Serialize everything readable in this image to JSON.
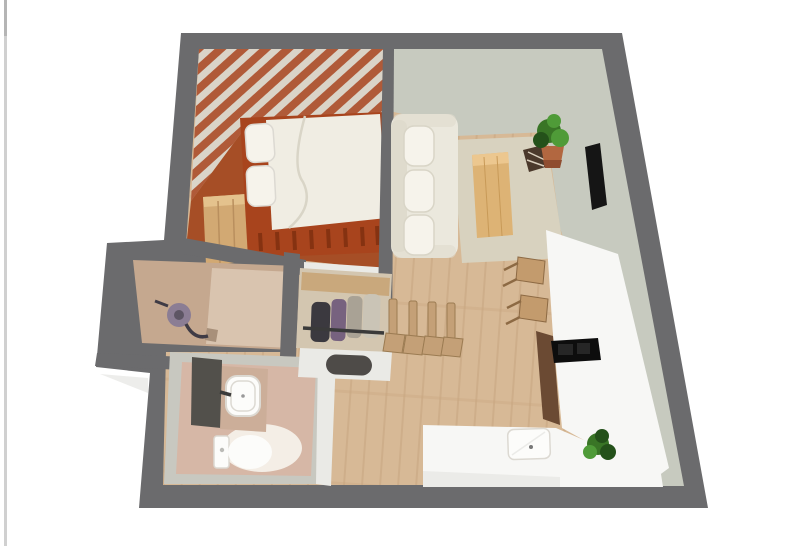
{
  "page": {
    "background": "#ffffff"
  },
  "floorplan": {
    "description": "3D top-down render of a studio apartment floor plan",
    "colors": {
      "wall": "#6b6b6d",
      "floor-wood": "#d7b996",
      "floor-wood-line": "#c7a67f",
      "sage-wall": "#c7cabf",
      "stripe-terracotta": "#b05a38",
      "stripe-cream": "#dad4c8",
      "bedroom-floor": "#a64e26",
      "bed-frame": "#a8441d",
      "bed-slat": "#7f3010",
      "duvet": "#f0ede3",
      "duvet-fold": "#d9d5c7",
      "pillow": "#f6f3eb",
      "wardrobe-wood": "#d2a973",
      "wardrobe-top": "#e4c28d",
      "wardrobe-seam": "#b98f5e",
      "sofa": "#ebe8dd",
      "sofa-shade": "#dfdbcd",
      "rug": "#d8d2bf",
      "table-wood": "#ddb375",
      "table-wood-light": "#ecc78f",
      "table-grain": "#c89a58",
      "plant-green": "#397526",
      "plant-green-light": "#4f9b38",
      "plant-dark": "#24511a",
      "pot": "#b26740",
      "pot-dark": "#8f4d30",
      "tv": "#151515",
      "decor-dark": "#4b392b",
      "decor-light": "#d9cebc",
      "counter": "#f7f7f5",
      "counter-shade": "#ebebe8",
      "cooktop": "#0d0d0d",
      "cooktop-inner": "#262626",
      "cabinet-brown": "#6b4a33",
      "stool-wood": "#c39b6d",
      "stool-leg": "#8d6a44",
      "chair-wood": "#c4a077",
      "chair-edge": "#9b7b52",
      "balcony-floor": "#c5a88f",
      "balcony-floor-light": "#d9c4af",
      "balcony-drain": "#a8907a",
      "bathroom-ring": "#c8c8c0",
      "bathroom-floor": "#d6b7a6",
      "vanity-top": "#ccae99",
      "fixture-white": "#fcfcfa",
      "fixture-edge": "#dcd9d2",
      "glow-white": "#f6f0e9",
      "panel-dark": "#52504b",
      "mat-dark": "#4e4b48",
      "partition-white": "#eaeae6",
      "closet-floor": "#d3c6b0",
      "closet-shelf": "#c9a87c",
      "rail-dark": "#3a3a3a",
      "clothes-dark": "#3b393f",
      "clothes-purple": "#77627f",
      "clothes-gray": "#a9a295",
      "clothes-light": "#cac4b6",
      "vacuum-purple": "#8b7d94",
      "vacuum-dark": "#3f3b45",
      "page-edge": "#d0d0d0",
      "page-edge-dark": "#b5b5b5",
      "shadow": "#ededeb"
    },
    "rooms": [
      {
        "name": "bedroom",
        "features": [
          "striped wallpaper",
          "double bed",
          "wardrobe"
        ]
      },
      {
        "name": "living-area",
        "features": [
          "sofa",
          "rug",
          "coffee table",
          "potted plant",
          "wall tv",
          "magazine rack"
        ]
      },
      {
        "name": "kitchen",
        "features": [
          "l-shaped counter",
          "cooktop",
          "sink",
          "bar stools",
          "counter plant"
        ]
      },
      {
        "name": "hallway",
        "features": [
          "open coat rack",
          "doormat bench",
          "row of chairs"
        ]
      },
      {
        "name": "bathroom",
        "features": [
          "shower panel",
          "washbasin vanity",
          "toilet"
        ]
      },
      {
        "name": "balcony-storage",
        "features": [
          "vacuum cleaner"
        ]
      }
    ]
  }
}
